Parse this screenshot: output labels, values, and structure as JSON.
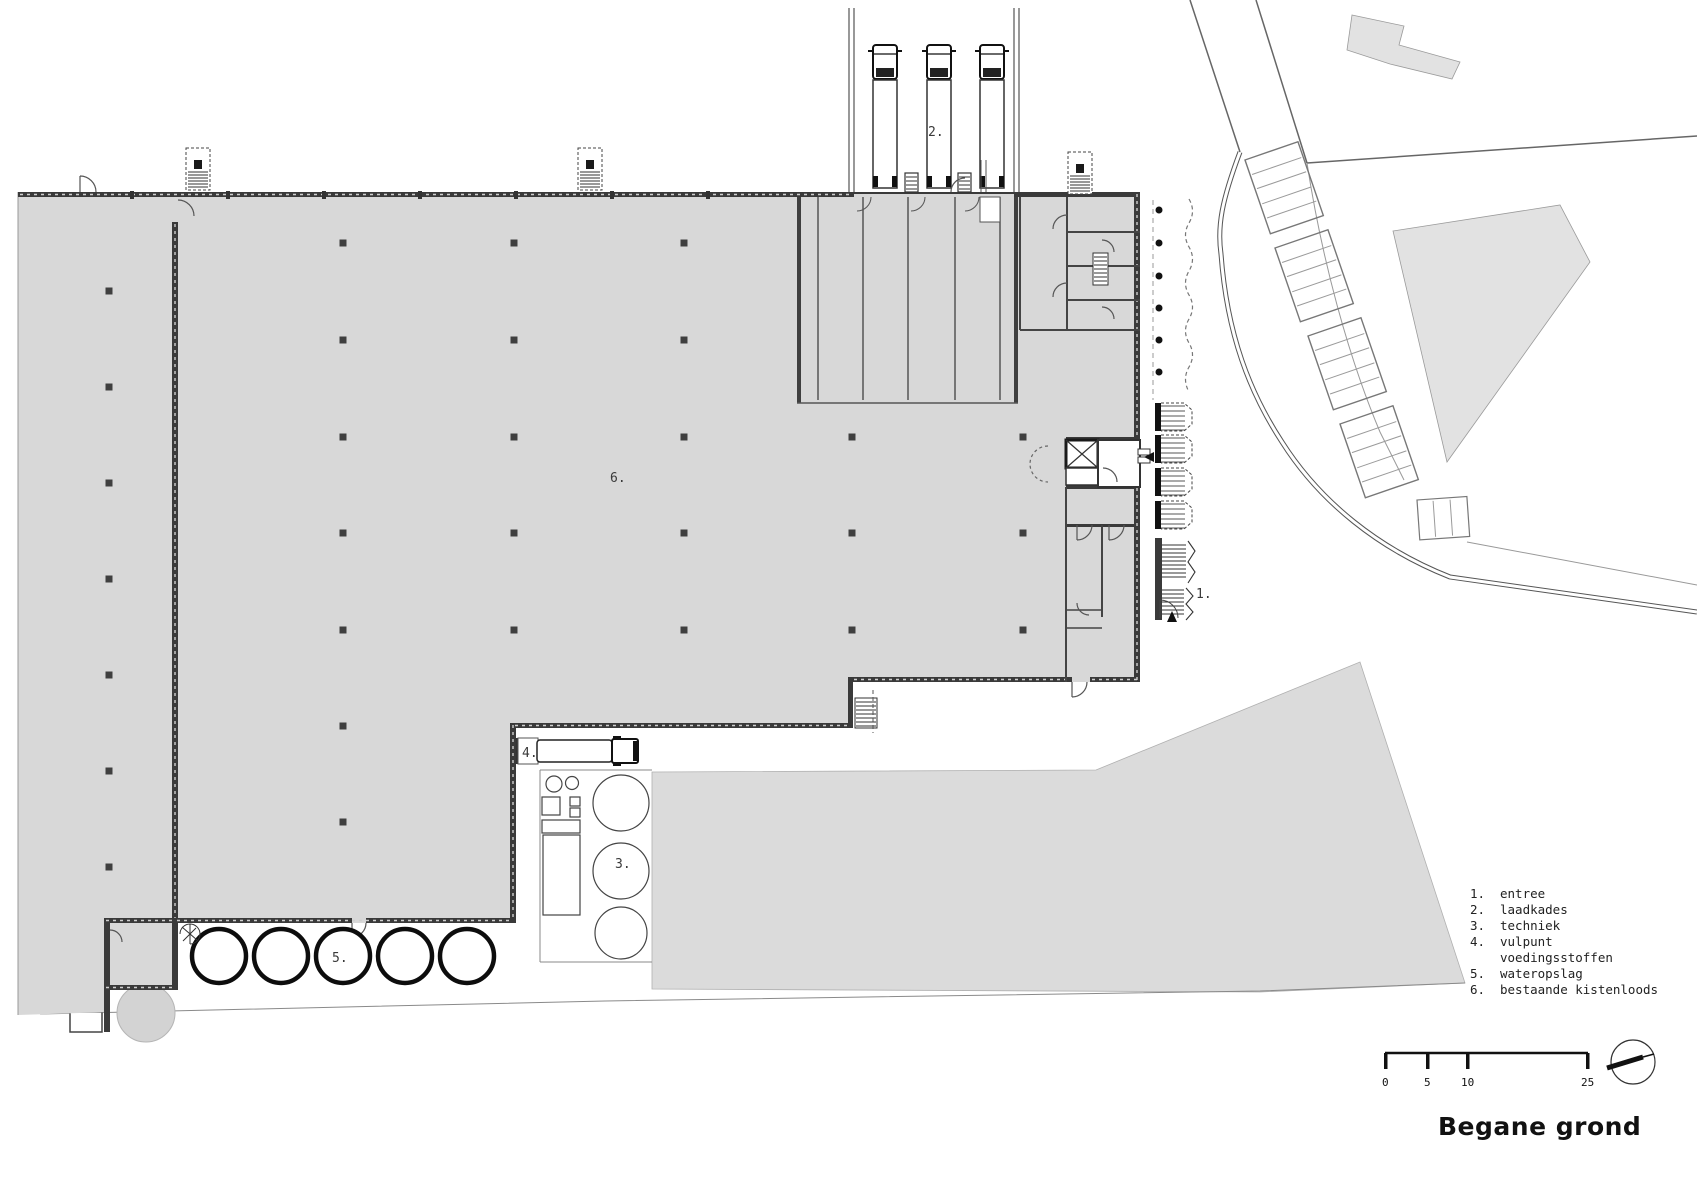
{
  "title": "Begane grond",
  "plan_labels": {
    "entree": "1.",
    "laadkades": "2.",
    "techniek": "3.",
    "vulpunt": "4.",
    "wateropslag": "5.",
    "kistenloods": "6."
  },
  "legend": {
    "items": [
      {
        "num": "1.",
        "label": "entree"
      },
      {
        "num": "2.",
        "label": "laadkades"
      },
      {
        "num": "3.",
        "label": "techniek"
      },
      {
        "num": "4.",
        "label": "vulpunt"
      },
      {
        "num": "",
        "label": "voedingsstoffen"
      },
      {
        "num": "5.",
        "label": "wateropslag"
      },
      {
        "num": "6.",
        "label": "bestaande kistenloods"
      }
    ]
  },
  "scale_bar": {
    "labels": [
      "0",
      "5",
      "10",
      "25"
    ]
  },
  "colors": {
    "floor": "#d8d8d8",
    "terrain": "#dbdbdb",
    "site_building": "#e2e2e2",
    "wall": "#3a3a3a",
    "ink": "#1a1a1a"
  }
}
